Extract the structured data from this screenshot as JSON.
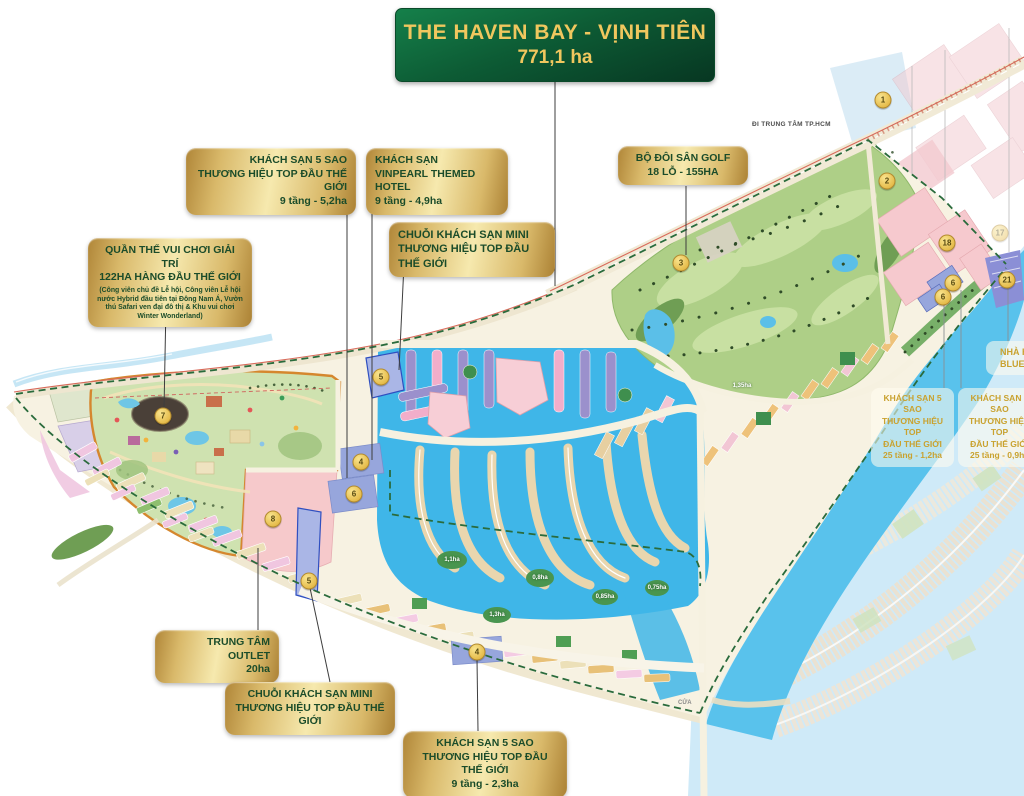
{
  "title": {
    "line1": "THE HAVEN BAY - VỊNH TIÊN",
    "line2": "771,1 ha"
  },
  "callouts": {
    "hotel5_top": {
      "lines": [
        "KHÁCH SẠN 5 SAO",
        "THƯƠNG HIỆU TOP ĐẦU THẾ GIỚI",
        "9 tầng - 5,2ha"
      ]
    },
    "vinpearl": {
      "lines": [
        "KHÁCH SẠN",
        "VINPEARL THEMED HOTEL",
        "9 tầng - 4,9ha"
      ]
    },
    "mini_top": {
      "lines": [
        "CHUỖI KHÁCH SẠN MINI",
        "THƯƠNG HIỆU TOP ĐẦU",
        "THẾ GIỚI"
      ]
    },
    "theme_park": {
      "title1": "QUẦN THỂ VUI CHƠI GIẢI TRÍ",
      "title2": "122HA HÀNG ĐẦU THẾ GIỚI",
      "desc": "(Công viên chủ đề Lễ hội, Công viên Lễ hội nước Hybrid đầu tiên tại Đông Nam Á, Vườn thú Safari ven đại đô thị & Khu vui chơi Winter Wonderland)"
    },
    "golf": {
      "lines": [
        "BỘ ĐÔI SÂN GOLF",
        "18 LỖ - 155HA"
      ]
    },
    "outlet": {
      "lines": [
        "TRUNG TÂM OUTLET",
        "20ha"
      ]
    },
    "mini_bottom": {
      "lines": [
        "CHUỖI KHÁCH SẠN MINI",
        "THƯƠNG HIỆU TOP ĐẦU THẾ GIỚI"
      ]
    },
    "hotel5_bottom": {
      "lines": [
        "KHÁCH SẠN 5 SAO",
        "THƯƠNG HIỆU TOP ĐẦU THẾ GIỚI",
        "9 tầng - 2,3ha"
      ]
    },
    "tower_12": {
      "lines": [
        "KHÁCH SẠN 5 SAO",
        "THƯƠNG HIỆU TOP",
        "ĐẦU THẾ GIỚI",
        "25 tầng - 1,2ha"
      ]
    },
    "tower_09": {
      "lines": [
        "KHÁCH SẠN 5 SAO",
        "THƯƠNG HIỆU TOP",
        "ĐẦU THẾ GIỚI",
        "25 tầng - 0,9ha"
      ]
    },
    "blue_v": {
      "lines": [
        "NHÀ H",
        "BLUE V"
      ]
    }
  },
  "map": {
    "road_label": "ĐI TRUNG TÂM TP.HCM",
    "river_label": "CỬA",
    "markers": [
      {
        "n": "1",
        "x": 883,
        "y": 100
      },
      {
        "n": "2",
        "x": 887,
        "y": 181
      },
      {
        "n": "3",
        "x": 681,
        "y": 263
      },
      {
        "n": "7",
        "x": 163,
        "y": 416
      },
      {
        "n": "8",
        "x": 273,
        "y": 519
      },
      {
        "n": "5",
        "x": 381,
        "y": 377
      },
      {
        "n": "4",
        "x": 361,
        "y": 462
      },
      {
        "n": "6",
        "x": 354,
        "y": 494
      },
      {
        "n": "5",
        "x": 309,
        "y": 581
      },
      {
        "n": "4",
        "x": 477,
        "y": 652
      },
      {
        "n": "18",
        "x": 947,
        "y": 243
      },
      {
        "n": "17",
        "x": 1000,
        "y": 233,
        "faded": true
      },
      {
        "n": "6",
        "x": 953,
        "y": 283
      },
      {
        "n": "6",
        "x": 943,
        "y": 297
      },
      {
        "n": "21",
        "x": 1007,
        "y": 280
      }
    ],
    "area_labels": [
      {
        "t": "1,1ha",
        "x": 452,
        "y": 560
      },
      {
        "t": "0,8ha",
        "x": 540,
        "y": 578
      },
      {
        "t": "0,85ha",
        "x": 605,
        "y": 597
      },
      {
        "t": "0,75ha",
        "x": 657,
        "y": 588
      },
      {
        "t": "1,3ha",
        "x": 497,
        "y": 615
      },
      {
        "t": "1,35ha",
        "x": 742,
        "y": 386
      }
    ]
  },
  "colors": {
    "accent_gold": "#d9b96a",
    "title_green": "#0d5c35",
    "gold_text": "#f0c75e",
    "water": "#3fb6e8",
    "golf_green": "#aecf87",
    "boundary_green": "#2a6b3c",
    "parcel_pink": "#f6c9ce"
  }
}
